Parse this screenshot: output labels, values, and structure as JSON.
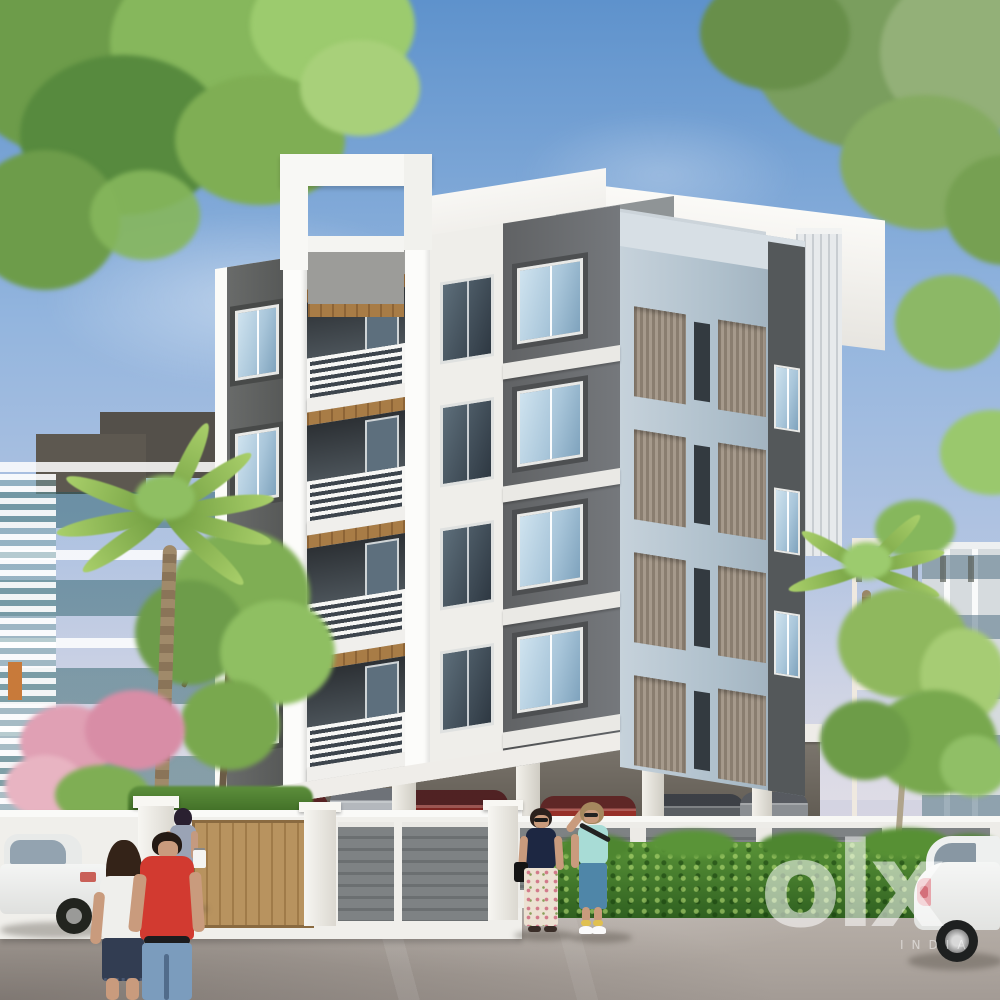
{
  "image": {
    "type": "3d-architectural-render",
    "subject": "Modern five-level apartment building with stilt parking, compound wall, landscaping, pedestrians and cars",
    "setting": "daytime, clear sky",
    "width_px": 1000,
    "height_px": 1000
  },
  "watermark": {
    "logo_text": "olx",
    "sub_text": "INDIA"
  },
  "palette": {
    "sky_top": "#5e92cc",
    "sky_mid": "#93b5de",
    "sky_horizon": "#dfdde4",
    "charcoal": "#606264",
    "charcoal_dark": "#4d4f51",
    "white_wall": "#f3f2ee",
    "blue_gray_facade": "#b3c2ce",
    "louver_brown": "#8d8174",
    "balcony_wood": "#a87c46",
    "glass_light": "#cfe3ef",
    "glass_dark": "#7fa3bd",
    "cyan_building": "#93ccce",
    "orange_building": "#c8693d",
    "hedge_light": "#5a9438",
    "hedge_dark": "#2f6020",
    "foliage_green": "#7fae54",
    "flower_pink": "#dfa0b4",
    "road_gray": "#b5ada6",
    "skin": "#c99b7d",
    "red_shirt": "#d23a30",
    "navy_top": "#1d2742",
    "teal_top": "#a8dcd6",
    "jeans_blue": "#7b9cbd",
    "watermark_white": "#ffffff"
  },
  "scene": {
    "main_building": {
      "floors_above_stilt": 4,
      "balconies": 4,
      "front_window_columns": 3,
      "right_facade_louver_columns": 2,
      "right_facade_windows": 3,
      "stilt_columns": 5,
      "parked_cars_under_stilt": 6
    },
    "background_buildings": [
      "cyan apartment block (left)",
      "orange block (right)",
      "light gray block (far right)"
    ],
    "vegetation": [
      "tree canopy top-left",
      "tree canopy top-right",
      "palm tree left",
      "palm tree right",
      "pink flowering tree",
      "green trees",
      "boundary hedge"
    ],
    "people": [
      {
        "id": "man-red-shirt",
        "desc": "man in red t-shirt and blue jeans, walking away"
      },
      {
        "id": "woman-white-tee",
        "desc": "woman with long dark hair, white tee, dark shorts, walking away"
      },
      {
        "id": "woman-gray-dress",
        "desc": "woman in gray dress carrying bag, walking toward gate"
      },
      {
        "id": "woman-navy-top",
        "desc": "woman in navy top and floral trousers walking"
      },
      {
        "id": "woman-teal-top",
        "desc": "woman in teal tee and capri jeans walking"
      }
    ],
    "vehicles": [
      "white sedan (left edge)",
      "white hatchback (right edge)",
      "cars parked under building"
    ]
  }
}
